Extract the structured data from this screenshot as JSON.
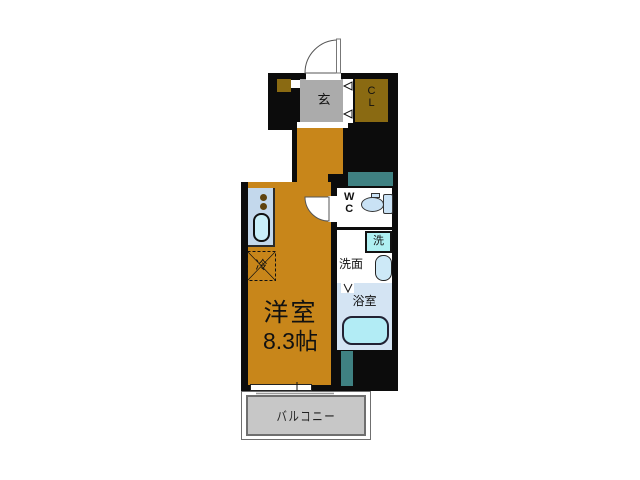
{
  "floorplan": {
    "rooms": {
      "entrance": {
        "label": "玄"
      },
      "closet": {
        "line1": "C",
        "line2": "L"
      },
      "wc": {
        "line1": "W",
        "line2": "C"
      },
      "washer": {
        "label": "洗"
      },
      "washroom": {
        "label": "洗面"
      },
      "bathroom": {
        "label": "浴室"
      },
      "fridge": {
        "label": "冷"
      },
      "main_room": {
        "name": "洋室",
        "size": "8.3帖"
      },
      "balcony": {
        "label": "バルコニー"
      }
    },
    "colors": {
      "wall": "#0c0c0c",
      "room_floor": "#c8861a",
      "closet_brown": "#8a6a12",
      "genkan_gray": "#ababab",
      "pipe_space_teal": "#3f8182",
      "bath_floor": "#d4e4f3",
      "fixture_cyan": "#b2ecf5",
      "counter_blue": "#c3d8ec",
      "balcony_gray": "#c7c7c7"
    }
  }
}
